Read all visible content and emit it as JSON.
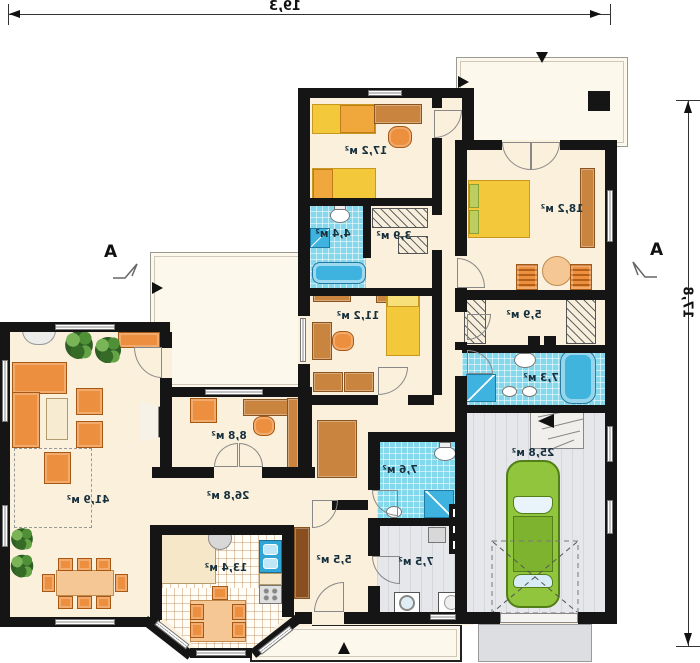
{
  "plan": {
    "dim_width": "19,3",
    "dim_height": "17,8",
    "section_marker": "A",
    "rooms": {
      "living": "41,9 м²",
      "hall": "26,8 м²",
      "kitchen": "13,4 м²",
      "office": "8,8 м²",
      "bedroom2": "11,2 м²",
      "kids": "17,2 м²",
      "bath1": "4,4 м²",
      "closet1": "3,9 м²",
      "bedroom1": "18,2 м²",
      "closet2": "5,9 м²",
      "bath2": "7,3 м²",
      "garage": "25,8 м²",
      "bath3": "7,6 м²",
      "utility": "7,5 м²",
      "vestibule": "5,5 м²"
    },
    "colors": {
      "wall": "#151515",
      "room_fill": "#fbf0dc",
      "tile_blue": "#84d8ec",
      "furniture_orange": "#ec8f3e",
      "bed_yellow": "#f3c83b",
      "car_green": "#90c53d",
      "floor_gray": "#e6e7ea"
    }
  }
}
